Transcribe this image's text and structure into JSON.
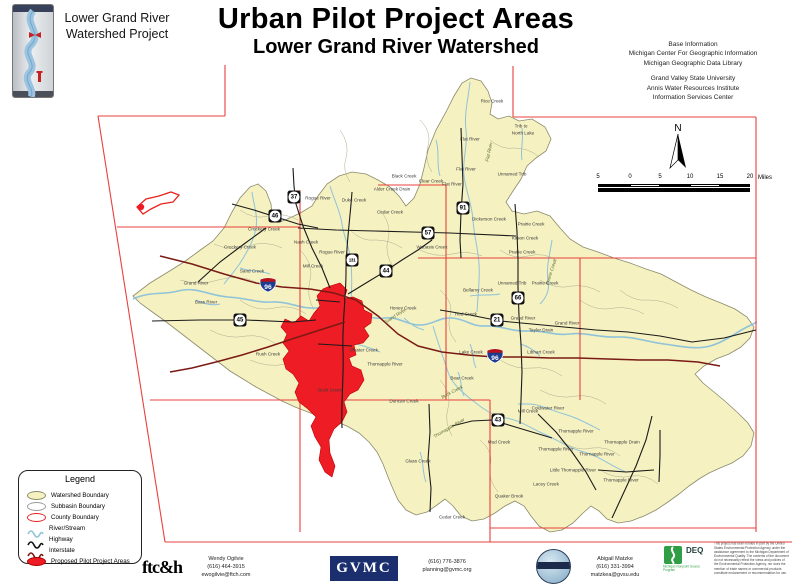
{
  "header": {
    "logo_line1": "Lower Grand River",
    "logo_line2": "Watershed Project",
    "title": "Urban Pilot Project Areas",
    "subtitle": "Lower Grand River Watershed",
    "base_info_lines": [
      "Base Information",
      "Michigan Center For Geographic Information",
      "Michigan Geographic Data Library",
      "Grand Valley State University",
      "Annis Water Resources Institute",
      "Information Services Center"
    ]
  },
  "compass": {
    "label": "N"
  },
  "scale_bar": {
    "ticks": [
      "5",
      "0",
      "5",
      "10",
      "15",
      "20"
    ],
    "unit": "Miles"
  },
  "legend": {
    "title": "Legend",
    "items": [
      {
        "label": "Watershed Boundary",
        "swatch": "watershed-ellipse"
      },
      {
        "label": "Subbasin Boundary",
        "swatch": "subbasin-ellipse"
      },
      {
        "label": "County Boundary",
        "swatch": "county-ellipse"
      },
      {
        "label": "River/Stream",
        "swatch": "river-line"
      },
      {
        "label": "Highway",
        "swatch": "highway-line"
      },
      {
        "label": "Interstate",
        "swatch": "interstate-line"
      },
      {
        "label": "Proposed Pilot Project Areas",
        "swatch": "pilot-ellipse"
      }
    ]
  },
  "colors": {
    "watershed_fill": "#f5f1c1",
    "county_boundary": "#e8413c",
    "pilot_area": "#ee1c25",
    "river": "#8fc3da",
    "highway": "#1a1a1a",
    "interstate": "#7a1a14",
    "gvmc_navy": "#1b2f6e",
    "deq_green": "#2f9e44"
  },
  "map": {
    "shields": [
      {
        "kind": "state",
        "num": "37",
        "x": 294,
        "y": 197
      },
      {
        "kind": "state",
        "num": "46",
        "x": 275,
        "y": 216
      },
      {
        "kind": "state",
        "num": "131",
        "x": 352,
        "y": 260
      },
      {
        "kind": "state",
        "num": "44",
        "x": 386,
        "y": 271
      },
      {
        "kind": "state",
        "num": "91",
        "x": 463,
        "y": 208
      },
      {
        "kind": "state",
        "num": "57",
        "x": 428,
        "y": 233
      },
      {
        "kind": "state",
        "num": "66",
        "x": 518,
        "y": 298
      },
      {
        "kind": "state",
        "num": "21",
        "x": 497,
        "y": 320
      },
      {
        "kind": "state",
        "num": "45",
        "x": 240,
        "y": 320
      },
      {
        "kind": "state",
        "num": "43",
        "x": 498,
        "y": 420
      },
      {
        "kind": "interstate",
        "num": "96",
        "x": 268,
        "y": 285
      },
      {
        "kind": "interstate",
        "num": "96",
        "x": 495,
        "y": 356
      }
    ],
    "labels": [
      {
        "text": "Crockery Creek",
        "x": 240,
        "y": 247
      },
      {
        "text": "Crockery Creek",
        "x": 264,
        "y": 229
      },
      {
        "text": "Nash Creek",
        "x": 306,
        "y": 242
      },
      {
        "text": "Rogue River",
        "x": 318,
        "y": 198
      },
      {
        "text": "Duke Creek",
        "x": 354,
        "y": 200
      },
      {
        "text": "Rogue River",
        "x": 332,
        "y": 252
      },
      {
        "text": "Cedar Creek",
        "x": 390,
        "y": 212
      },
      {
        "text": "Wabasis Creek",
        "x": 432,
        "y": 247
      },
      {
        "text": "Black Creek",
        "x": 404,
        "y": 176
      },
      {
        "text": "Clear Creek",
        "x": 431,
        "y": 181
      },
      {
        "text": "Alder Creek Drain",
        "x": 392,
        "y": 189
      },
      {
        "text": "Flat River",
        "x": 470,
        "y": 139
      },
      {
        "text": "Flat River",
        "x": 466,
        "y": 169
      },
      {
        "text": "Flat River",
        "x": 452,
        "y": 184
      },
      {
        "text": "Flat River",
        "x": 489,
        "y": 152,
        "rot": -78,
        "cls": "river"
      },
      {
        "text": "Rice Creek",
        "x": 492,
        "y": 101
      },
      {
        "text": "Trib to",
        "x": 521,
        "y": 126
      },
      {
        "text": "North Lake",
        "x": 523,
        "y": 133
      },
      {
        "text": "Unnamed Trib",
        "x": 512,
        "y": 174
      },
      {
        "text": "Dickerson Creek",
        "x": 489,
        "y": 219
      },
      {
        "text": "Prairie Creek",
        "x": 531,
        "y": 224
      },
      {
        "text": "Kitson Creek",
        "x": 525,
        "y": 238
      },
      {
        "text": "Prairie Creek",
        "x": 522,
        "y": 252
      },
      {
        "text": "Prairie Creek",
        "x": 551,
        "y": 272,
        "rot": -72,
        "cls": "river"
      },
      {
        "text": "Unnamed Trib",
        "x": 512,
        "y": 283
      },
      {
        "text": "Bellamy Creek",
        "x": 478,
        "y": 290
      },
      {
        "text": "Prairie Creek",
        "x": 545,
        "y": 283
      },
      {
        "text": "Grand River",
        "x": 196,
        "y": 283
      },
      {
        "text": "Bass River",
        "x": 206,
        "y": 302
      },
      {
        "text": "Sand Creek",
        "x": 252,
        "y": 271
      },
      {
        "text": "Mill Creek",
        "x": 313,
        "y": 266
      },
      {
        "text": "Grand River",
        "x": 395,
        "y": 316,
        "rot": -32,
        "cls": "river"
      },
      {
        "text": "Honey Creek",
        "x": 403,
        "y": 308
      },
      {
        "text": "Grand River",
        "x": 523,
        "y": 318
      },
      {
        "text": "Taylor Drain",
        "x": 541,
        "y": 330
      },
      {
        "text": "Grand River",
        "x": 567,
        "y": 323
      },
      {
        "text": "Red Creek",
        "x": 466,
        "y": 314
      },
      {
        "text": "Rush Creek",
        "x": 268,
        "y": 354
      },
      {
        "text": "Plaster Creek",
        "x": 364,
        "y": 350
      },
      {
        "text": "Buck Creek",
        "x": 330,
        "y": 390
      },
      {
        "text": "Lake Creek",
        "x": 471,
        "y": 352
      },
      {
        "text": "Bear Creek",
        "x": 462,
        "y": 378
      },
      {
        "text": "Buck Creek",
        "x": 452,
        "y": 392,
        "rot": -28,
        "cls": "river"
      },
      {
        "text": "Libhart Creek",
        "x": 541,
        "y": 352
      },
      {
        "text": "Thornapple River",
        "x": 385,
        "y": 364
      },
      {
        "text": "Duncan Creek",
        "x": 404,
        "y": 401
      },
      {
        "text": "Coldwater River",
        "x": 548,
        "y": 408
      },
      {
        "text": "Mill Creek",
        "x": 528,
        "y": 411
      },
      {
        "text": "Mud Creek",
        "x": 499,
        "y": 442
      },
      {
        "text": "Thornapple River",
        "x": 576,
        "y": 431
      },
      {
        "text": "Thornapple River",
        "x": 556,
        "y": 449
      },
      {
        "text": "Thornapple River",
        "x": 597,
        "y": 454
      },
      {
        "text": "Thornapple Drain",
        "x": 622,
        "y": 442
      },
      {
        "text": "Little Thornapple River",
        "x": 573,
        "y": 470
      },
      {
        "text": "Thornapple River",
        "x": 621,
        "y": 480
      },
      {
        "text": "Lacey Creek",
        "x": 546,
        "y": 484
      },
      {
        "text": "Quaker Brook",
        "x": 509,
        "y": 496
      },
      {
        "text": "Glass Creek",
        "x": 418,
        "y": 461
      },
      {
        "text": "Cedar Creek",
        "x": 452,
        "y": 517
      },
      {
        "text": "Thornapple River",
        "x": 449,
        "y": 428,
        "rot": -30,
        "cls": "river"
      }
    ]
  },
  "footer": {
    "ftch_logo": "ftc&h",
    "contact1": [
      "Wendy Ogilvie",
      "(616) 464-3915",
      "ewogilvie@ftch.com"
    ],
    "gvmc_logo": "GVMC",
    "contact2": [
      "(616) 776-3876",
      "planning@gvmc.org"
    ],
    "contact3": [
      "Abigail Matzke",
      "(616) 331-3994",
      "matzkea@gvsu.edu"
    ],
    "deq": {
      "acronym": "DEQ",
      "program": "Michigan Nonpoint Source Program",
      "disclaimer": "This project has been funded in part by the United States Environmental Protection Agency under the assistance agreement to the Michigan Department of Environmental Quality. The contents of the document do not necessarily reflect the views and policies of the Environmental Protection Agency, nor does the mention of trade names or commercial products constitute endorsement or recommendation for use."
    }
  }
}
